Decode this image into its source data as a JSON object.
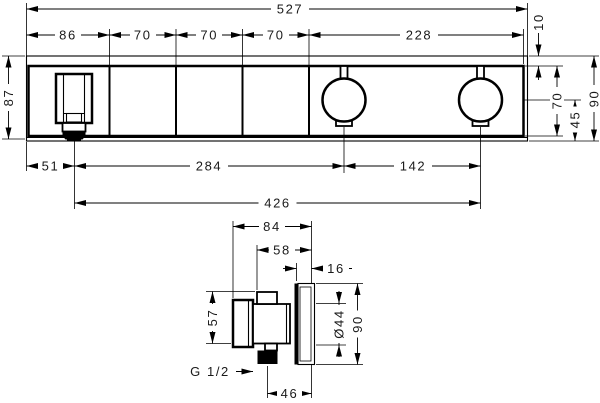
{
  "front_view": {
    "dims": {
      "total_width": "527",
      "segments": [
        "86",
        "70",
        "70",
        "70",
        "228"
      ],
      "top_gap": "10",
      "left_height": "87",
      "face_height": "70",
      "center_to_bottom": "45",
      "right_height": "90",
      "bottom_row": [
        "51",
        "284",
        "142"
      ],
      "overall_bottom": "426"
    }
  },
  "side_view": {
    "dims": {
      "total_depth": "84",
      "body_depth": "58",
      "plate_gap": "16",
      "body_height": "57",
      "flange_diameter": "Ø44",
      "plate_height": "90",
      "thread": "G 1/2",
      "outlet_to_plate": "46"
    }
  }
}
